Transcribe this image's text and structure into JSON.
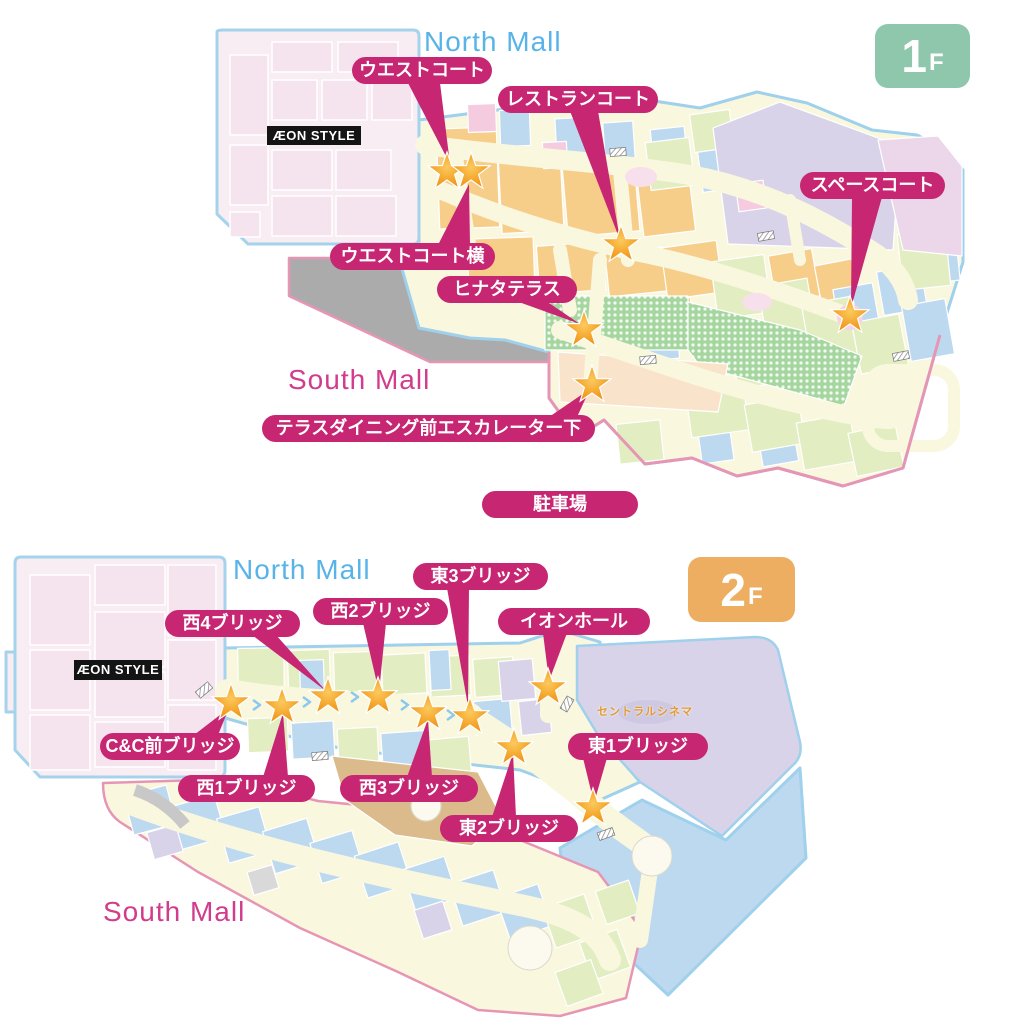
{
  "floor1": {
    "floor_badge": {
      "number": "1",
      "suffix": "F"
    },
    "north_mall_label": "North Mall",
    "south_mall_label": "South Mall",
    "aeon_style_logo": "ÆON STYLE",
    "parking_badge": "駐車場",
    "locations": {
      "west_court": "ウエストコート",
      "restaurant_court": "レストランコート",
      "space_court": "スペースコート",
      "west_court_side": "ウエストコート横",
      "hinata_terrace": "ヒナタテラス",
      "terrace_dining": "テラスダイニング前エスカレーター下"
    }
  },
  "floor2": {
    "floor_badge": {
      "number": "2",
      "suffix": "F"
    },
    "north_mall_label": "North Mall",
    "south_mall_label": "South Mall",
    "aeon_style_logo": "ÆON STYLE",
    "central_cinema_label": "セントラルシネマ",
    "locations": {
      "east3_bridge": "東3ブリッジ",
      "west2_bridge": "西2ブリッジ",
      "west4_bridge": "西4ブリッジ",
      "aeon_hall": "イオンホール",
      "cc_front_bridge": "C&C前ブリッジ",
      "west1_bridge": "西1ブリッジ",
      "west3_bridge": "西3ブリッジ",
      "east2_bridge": "東2ブリッジ",
      "east1_bridge": "東1ブリッジ"
    }
  },
  "colors": {
    "badge_magenta": "#c62672",
    "north_mall_blue": "#58b4e8",
    "south_mall_pink": "#d13c8c",
    "floor1_badge_green": "#8ec7ab",
    "floor2_badge_orange": "#edae62",
    "star_orange": "#f0981e",
    "map_cream": "#faf7df",
    "map_outline_blue": "#9fd0ec",
    "map_outline_pink": "#e795b5"
  }
}
